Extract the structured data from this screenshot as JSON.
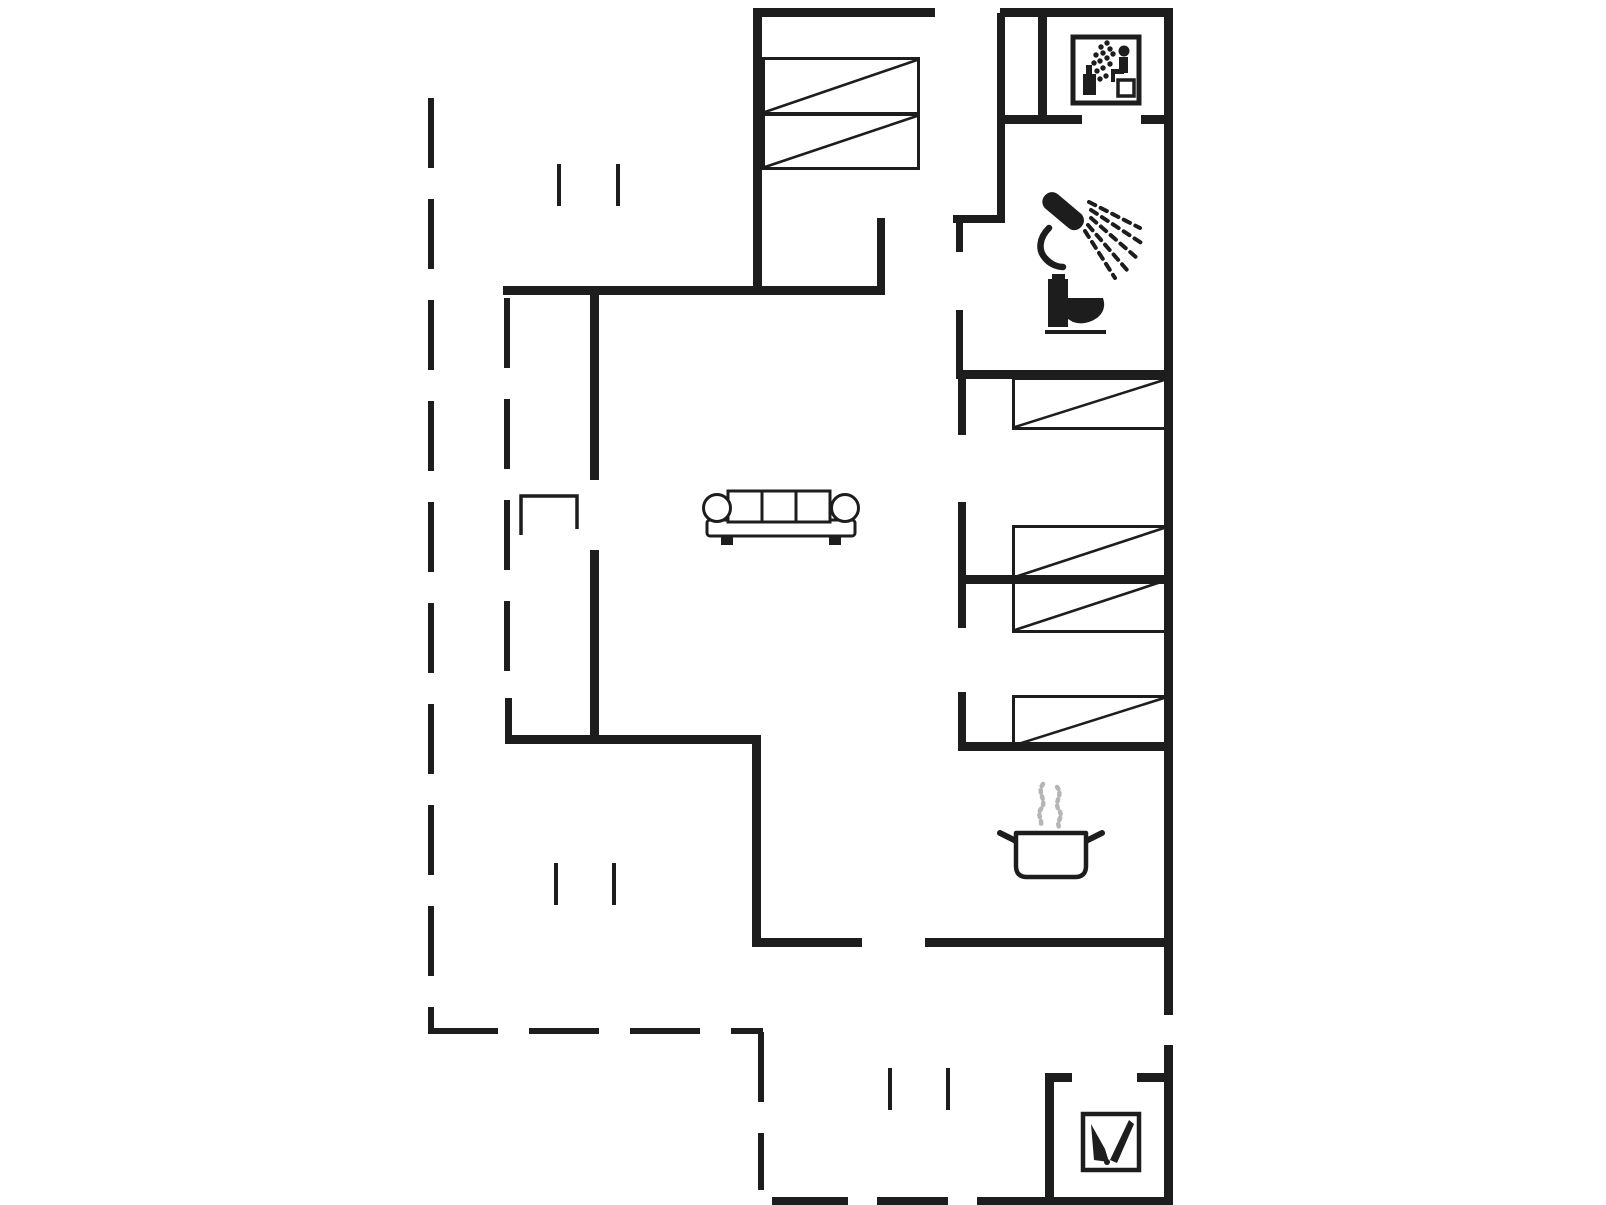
{
  "canvas": {
    "w": 1606,
    "h": 1205,
    "bg": "#ffffff",
    "ink": "#1d1d1d",
    "steam": "#b5b5b5"
  },
  "plan": {
    "walls": [
      {
        "x": 753,
        "y": 8,
        "w": 182,
        "h": 9
      },
      {
        "x": 1000,
        "y": 8,
        "w": 173,
        "h": 9
      },
      {
        "x": 1164,
        "y": 8,
        "w": 9,
        "h": 1007
      },
      {
        "x": 1164,
        "y": 1045,
        "w": 9,
        "h": 160
      },
      {
        "x": 753,
        "y": 8,
        "w": 9,
        "h": 287
      },
      {
        "x": 503,
        "y": 286,
        "w": 382,
        "h": 9
      },
      {
        "x": 877,
        "y": 218,
        "w": 8,
        "h": 77
      },
      {
        "x": 953,
        "y": 215,
        "w": 52,
        "h": 8
      },
      {
        "x": 997,
        "y": 13,
        "w": 8,
        "h": 209
      },
      {
        "x": 1038,
        "y": 13,
        "w": 9,
        "h": 109
      },
      {
        "x": 997,
        "y": 115,
        "w": 85,
        "h": 9
      },
      {
        "x": 1141,
        "y": 115,
        "w": 32,
        "h": 9
      },
      {
        "x": 956,
        "y": 223,
        "w": 7,
        "h": 29
      },
      {
        "x": 956,
        "y": 310,
        "w": 7,
        "h": 68
      },
      {
        "x": 956,
        "y": 370,
        "w": 217,
        "h": 9
      },
      {
        "x": 958,
        "y": 379,
        "w": 8,
        "h": 56
      },
      {
        "x": 958,
        "y": 502,
        "w": 8,
        "h": 126
      },
      {
        "x": 958,
        "y": 692,
        "w": 8,
        "h": 58
      },
      {
        "x": 958,
        "y": 575,
        "w": 209,
        "h": 9
      },
      {
        "x": 958,
        "y": 742,
        "w": 212,
        "h": 9
      },
      {
        "x": 755,
        "y": 938,
        "w": 107,
        "h": 9
      },
      {
        "x": 925,
        "y": 938,
        "w": 248,
        "h": 9
      },
      {
        "x": 752,
        "y": 742,
        "w": 9,
        "h": 205
      },
      {
        "x": 505,
        "y": 735,
        "w": 256,
        "h": 9
      },
      {
        "x": 590,
        "y": 293,
        "w": 9,
        "h": 187
      },
      {
        "x": 590,
        "y": 550,
        "w": 9,
        "h": 194
      },
      {
        "x": 505,
        "y": 698,
        "w": 7,
        "h": 40
      },
      {
        "x": 1045,
        "y": 1073,
        "w": 27,
        "h": 9
      },
      {
        "x": 1137,
        "y": 1073,
        "w": 36,
        "h": 9
      },
      {
        "x": 1045,
        "y": 1073,
        "w": 9,
        "h": 132
      },
      {
        "x": 772,
        "y": 1197,
        "w": 76,
        "h": 8
      },
      {
        "x": 877,
        "y": 1197,
        "w": 71,
        "h": 8
      },
      {
        "x": 977,
        "y": 1197,
        "w": 196,
        "h": 8
      }
    ],
    "dashed_lines": [
      {
        "x": 428,
        "y": 98,
        "len": 934,
        "orient": "v"
      },
      {
        "x": 504,
        "y": 298,
        "len": 400,
        "orient": "v"
      },
      {
        "x": 428,
        "y": 1028,
        "len": 335,
        "orient": "h"
      },
      {
        "x": 758,
        "y": 1032,
        "len": 158,
        "orient": "v"
      }
    ],
    "dash_style": {
      "thickness": 6,
      "dash": 70,
      "gap": 31
    },
    "window_ticks": [
      {
        "x": 557,
        "y": 164
      },
      {
        "x": 616,
        "y": 164
      },
      {
        "x": 554,
        "y": 863
      },
      {
        "x": 612,
        "y": 863
      },
      {
        "x": 888,
        "y": 1068
      },
      {
        "x": 946,
        "y": 1068
      }
    ],
    "tick_style": {
      "w": 4,
      "len": 42
    },
    "beds": [
      {
        "x": 762,
        "y": 57,
        "w": 158,
        "h": 58
      },
      {
        "x": 762,
        "y": 113,
        "w": 158,
        "h": 57
      },
      {
        "x": 1012,
        "y": 377,
        "w": 155,
        "h": 53
      },
      {
        "x": 1012,
        "y": 525,
        "w": 155,
        "h": 55
      },
      {
        "x": 1012,
        "y": 578,
        "w": 155,
        "h": 55
      },
      {
        "x": 1012,
        "y": 695,
        "w": 155,
        "h": 53
      }
    ],
    "furniture": {
      "sofa": {
        "x": 700,
        "y": 486,
        "w": 162,
        "h": 62
      },
      "side_table": {
        "x": 518,
        "y": 493,
        "w": 62,
        "h": 44
      }
    },
    "icons": [
      {
        "name": "sauna-icon",
        "x": 1070,
        "y": 34,
        "w": 72,
        "h": 72
      },
      {
        "name": "shower-icon",
        "x": 1035,
        "y": 188,
        "w": 115,
        "h": 105
      },
      {
        "name": "toilet-icon",
        "x": 1042,
        "y": 272,
        "w": 68,
        "h": 66
      },
      {
        "name": "cooking-pot-icon",
        "x": 995,
        "y": 780,
        "w": 112,
        "h": 102
      },
      {
        "name": "wood-stove-icon",
        "x": 1080,
        "y": 1111,
        "w": 62,
        "h": 62
      }
    ]
  }
}
